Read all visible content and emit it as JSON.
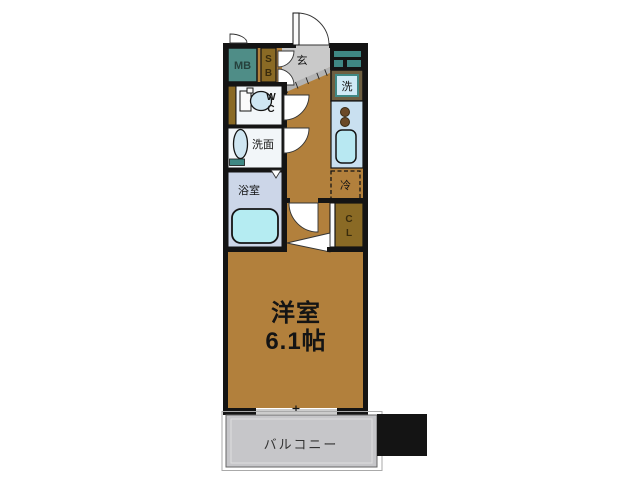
{
  "labels": {
    "meter_box": "MB",
    "shoe_box": [
      "S",
      "B"
    ],
    "entrance": "玄",
    "washing_machine": "洗",
    "toilet": [
      "W",
      "C"
    ],
    "washroom": "洗面",
    "bathroom": "浴室",
    "refrigerator": "冷",
    "closet": [
      "C",
      "L"
    ],
    "main_room_name": "洋室",
    "main_room_size": "6.1帖",
    "balcony": "バルコニー"
  },
  "colors": {
    "page-bg": "#ffffff",
    "wall": "#141414",
    "floor": "#b2803c",
    "mb-teal": "#4f8d87",
    "teal-accent": "#3f8884",
    "olive": "#8a6a25",
    "genkan-gray": "#c9c9c9",
    "hatch-gray": "#b3b3b3",
    "room-white": "#f2f6f9",
    "bath-bg": "#ccd6e8",
    "tub-cyan": "#b5ecf2",
    "kitchen-blue": "#c9e0f0",
    "sink-cyan": "#b8e8f2",
    "washer-blue": "#cfeaf6",
    "washer-frame": "#6e5f41",
    "burner-brown": "#6b4a28",
    "fixture-blue": "#cfe6f2",
    "balcony-gray": "#c6c6c9"
  }
}
